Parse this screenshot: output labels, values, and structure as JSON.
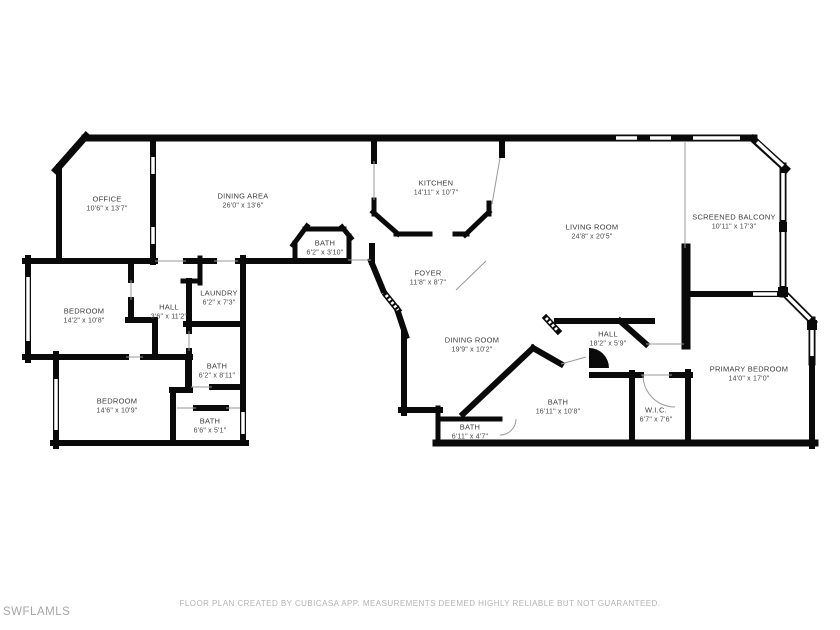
{
  "watermark": "SWFLAMLS",
  "disclaimer": "FLOOR PLAN CREATED BY CUBICASA APP. MEASUREMENTS DEEMED HIGHLY RELIABLE BUT NOT GUARANTEED.",
  "colors": {
    "wall": "#0a0a0a",
    "label": "#3c3c3c",
    "muted_text": "#b3b3b3",
    "watermark": "#a6a6a6",
    "background": "#ffffff"
  },
  "rooms": [
    {
      "id": "office",
      "name": "OFFICE",
      "dims": "10'6\" x 13'7\""
    },
    {
      "id": "dining-area",
      "name": "DINING AREA",
      "dims": "26'0\" x 13'6\""
    },
    {
      "id": "kitchen",
      "name": "KITCHEN",
      "dims": "14'11\" x 10'7\""
    },
    {
      "id": "living-room",
      "name": "LIVING ROOM",
      "dims": "24'8\" x 20'5\""
    },
    {
      "id": "screened-balcony",
      "name": "SCREENED BALCONY",
      "dims": "10'11\" x 17'3\""
    },
    {
      "id": "bath-pod",
      "name": "BATH",
      "dims": "6'2\" x 3'10\""
    },
    {
      "id": "foyer",
      "name": "FOYER",
      "dims": "11'8\" x 8'7\""
    },
    {
      "id": "bedroom-1",
      "name": "BEDROOM",
      "dims": "14'2\" x 10'8\""
    },
    {
      "id": "hall-1",
      "name": "HALL",
      "dims": "3'6\" x 11'2\""
    },
    {
      "id": "laundry",
      "name": "LAUNDRY",
      "dims": "6'2\" x 7'3\""
    },
    {
      "id": "bath-2",
      "name": "BATH",
      "dims": "6'2\" x 8'11\""
    },
    {
      "id": "dining-room",
      "name": "DINING ROOM",
      "dims": "19'9\" x 10'2\""
    },
    {
      "id": "hall-2",
      "name": "HALL",
      "dims": "18'2\" x 5'9\""
    },
    {
      "id": "bedroom-2",
      "name": "BEDROOM",
      "dims": "14'6\" x 10'9\""
    },
    {
      "id": "bath-3",
      "name": "BATH",
      "dims": "6'6\" x 5'1\""
    },
    {
      "id": "bath-4",
      "name": "BATH",
      "dims": "16'11\" x 10'8\""
    },
    {
      "id": "wic",
      "name": "W.I.C.",
      "dims": "6'7\" x 7'6\""
    },
    {
      "id": "primary-bedroom",
      "name": "PRIMARY BEDROOM",
      "dims": "14'0\" x 17'0\""
    },
    {
      "id": "bath-5",
      "name": "BATH",
      "dims": "6'11\" x 4'7\""
    }
  ]
}
